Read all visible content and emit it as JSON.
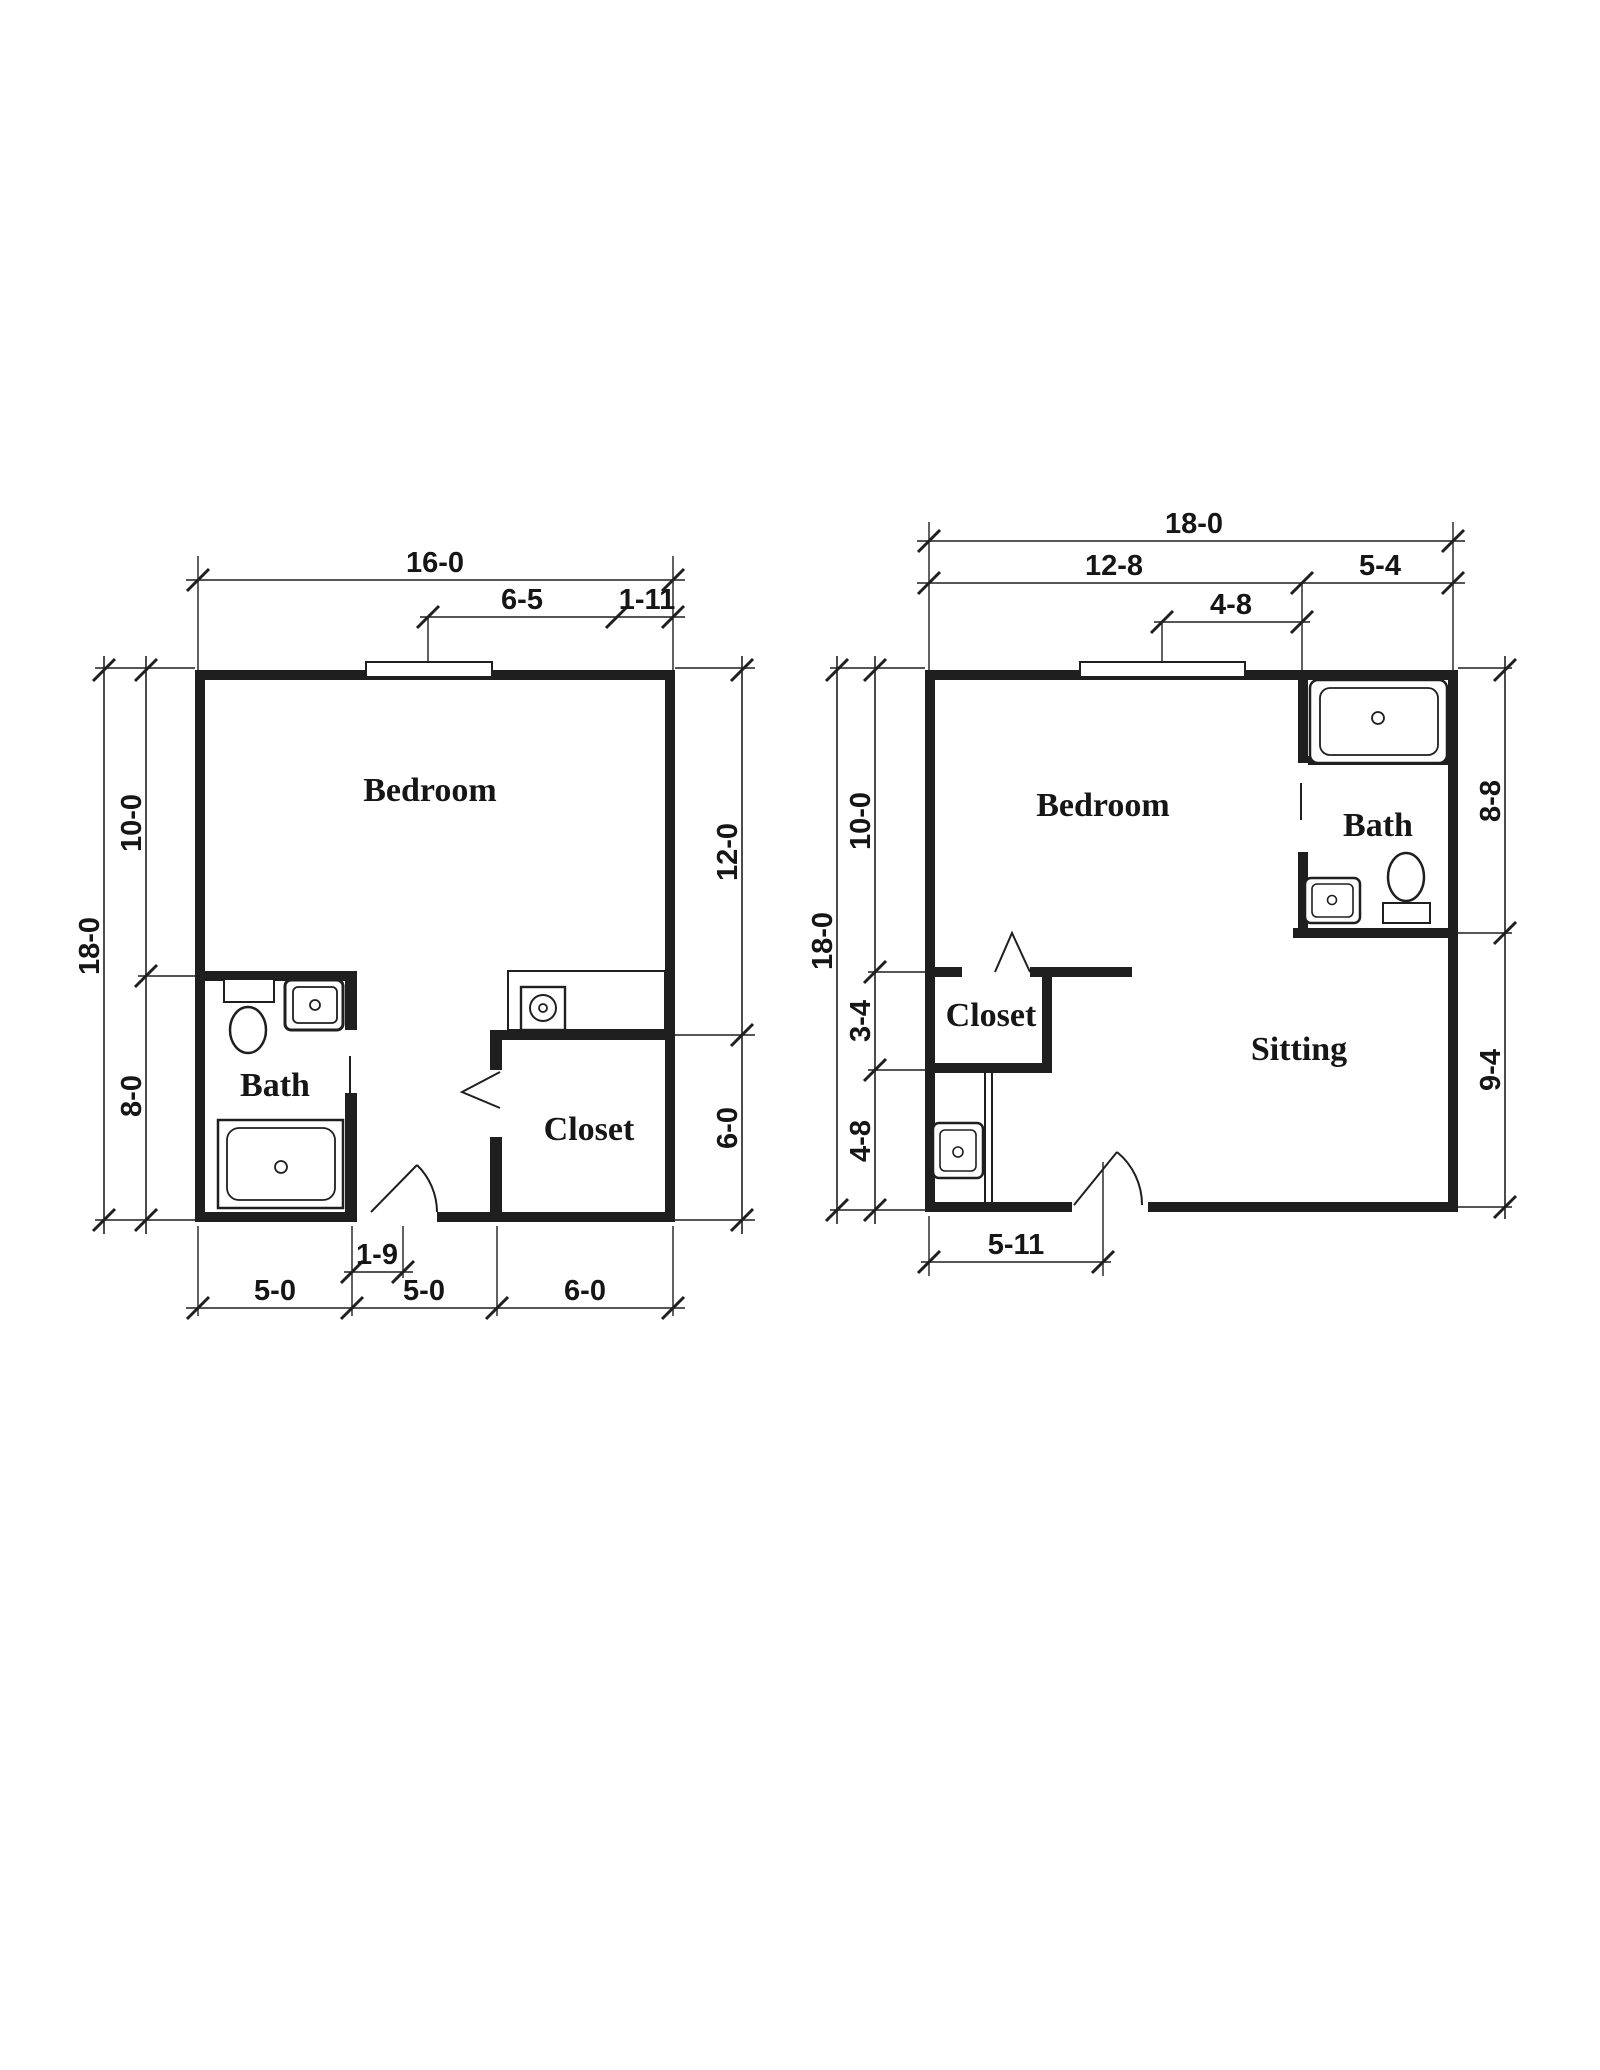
{
  "colors": {
    "background": "#ffffff",
    "ink": "#1f1f1f"
  },
  "plan_left": {
    "rooms": {
      "bedroom": "Bedroom",
      "bath": "Bath",
      "closet": "Closet"
    },
    "dims": {
      "overall_width": "16-0",
      "window_offset": "6-5",
      "window_corner": "1-11",
      "overall_height": "18-0",
      "left_upper": "10-0",
      "left_lower": "8-0",
      "right_upper": "12-0",
      "right_lower": "6-0",
      "door_offset": "1-9",
      "bottom_bath": "5-0",
      "bottom_mid": "5-0",
      "bottom_closet": "6-0"
    }
  },
  "plan_right": {
    "rooms": {
      "bedroom": "Bedroom",
      "bath": "Bath",
      "closet": "Closet",
      "sitting": "Sitting"
    },
    "dims": {
      "overall_width": "18-0",
      "top_left": "12-8",
      "top_right": "5-4",
      "window_offset": "4-8",
      "overall_height": "18-0",
      "left_upper": "10-0",
      "left_mid": "3-4",
      "left_lower": "4-8",
      "right_upper": "8-8",
      "right_lower": "9-4",
      "door_offset": "5-11"
    }
  }
}
